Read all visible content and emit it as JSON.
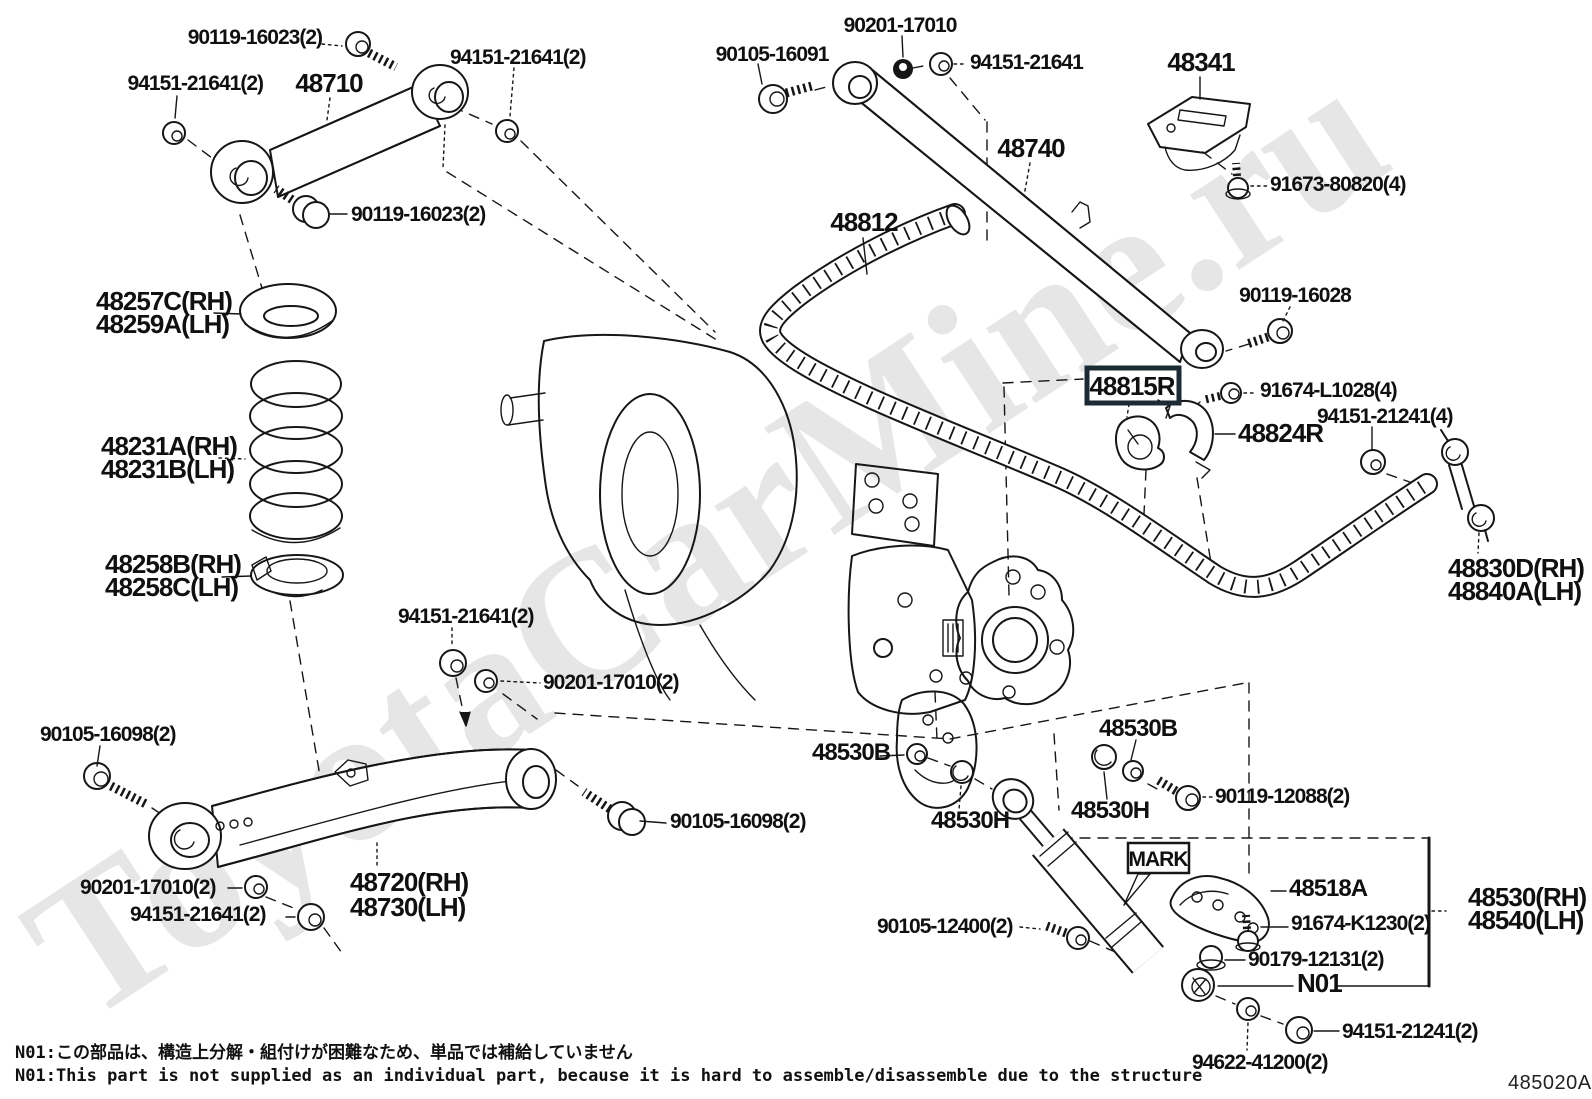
{
  "watermark": {
    "text": "ToyotaCarMine.ru",
    "color": "#e6e6e6"
  },
  "footer": {
    "note_jp": "N01:この部品は、構造上分解・組付けが困難なため、単品では補給していません",
    "note_en": "N01:This part is not supplied as an individual part, because it is hard to assemble/disassemble due to the structure",
    "diagram_code": "485020A"
  },
  "highlighted_parts": [
    "48815R"
  ],
  "labels": [
    {
      "text": "90119-16023(2)"
    },
    {
      "text": "94151-21641(2)"
    },
    {
      "text": "48710"
    },
    {
      "text": "94151-21641(2)"
    },
    {
      "text": "90119-16023(2)"
    },
    {
      "text": "90201-17010"
    },
    {
      "text": "90105-16091"
    },
    {
      "text": "94151-21641"
    },
    {
      "text": "48740"
    },
    {
      "text": "48812"
    },
    {
      "text": "48341"
    },
    {
      "text": "91673-80820(4)"
    },
    {
      "text": "90119-16028"
    },
    {
      "text": "48257C(RH)"
    },
    {
      "text": "48259A(LH)"
    },
    {
      "text": "48231A(RH)"
    },
    {
      "text": "48231B(LH)"
    },
    {
      "text": "48258B(RH)"
    },
    {
      "text": "48258C(LH)"
    },
    {
      "text": "48815R"
    },
    {
      "text": "91674-L1028(4)"
    },
    {
      "text": "48824R"
    },
    {
      "text": "94151-21241(4)"
    },
    {
      "text": "48830D(RH)"
    },
    {
      "text": "48840A(LH)"
    },
    {
      "text": "94151-21641(2)"
    },
    {
      "text": "90201-17010(2)"
    },
    {
      "text": "90105-16098(2)"
    },
    {
      "text": "90201-17010(2)"
    },
    {
      "text": "94151-21641(2)"
    },
    {
      "text": "48720(RH)"
    },
    {
      "text": "48730(LH)"
    },
    {
      "text": "90105-16098(2)"
    },
    {
      "text": "48530B"
    },
    {
      "text": "48530B"
    },
    {
      "text": "48530H"
    },
    {
      "text": "48530H"
    },
    {
      "text": "90119-12088(2)"
    },
    {
      "text": "MARK"
    },
    {
      "text": "48518A"
    },
    {
      "text": "90105-12400(2)"
    },
    {
      "text": "91674-K1230(2)"
    },
    {
      "text": "90179-12131(2)"
    },
    {
      "text": "N01"
    },
    {
      "text": "94151-21241(2)"
    },
    {
      "text": "94622-41200(2)"
    },
    {
      "text": "48530(RH)"
    },
    {
      "text": "48540(LH)"
    }
  ]
}
